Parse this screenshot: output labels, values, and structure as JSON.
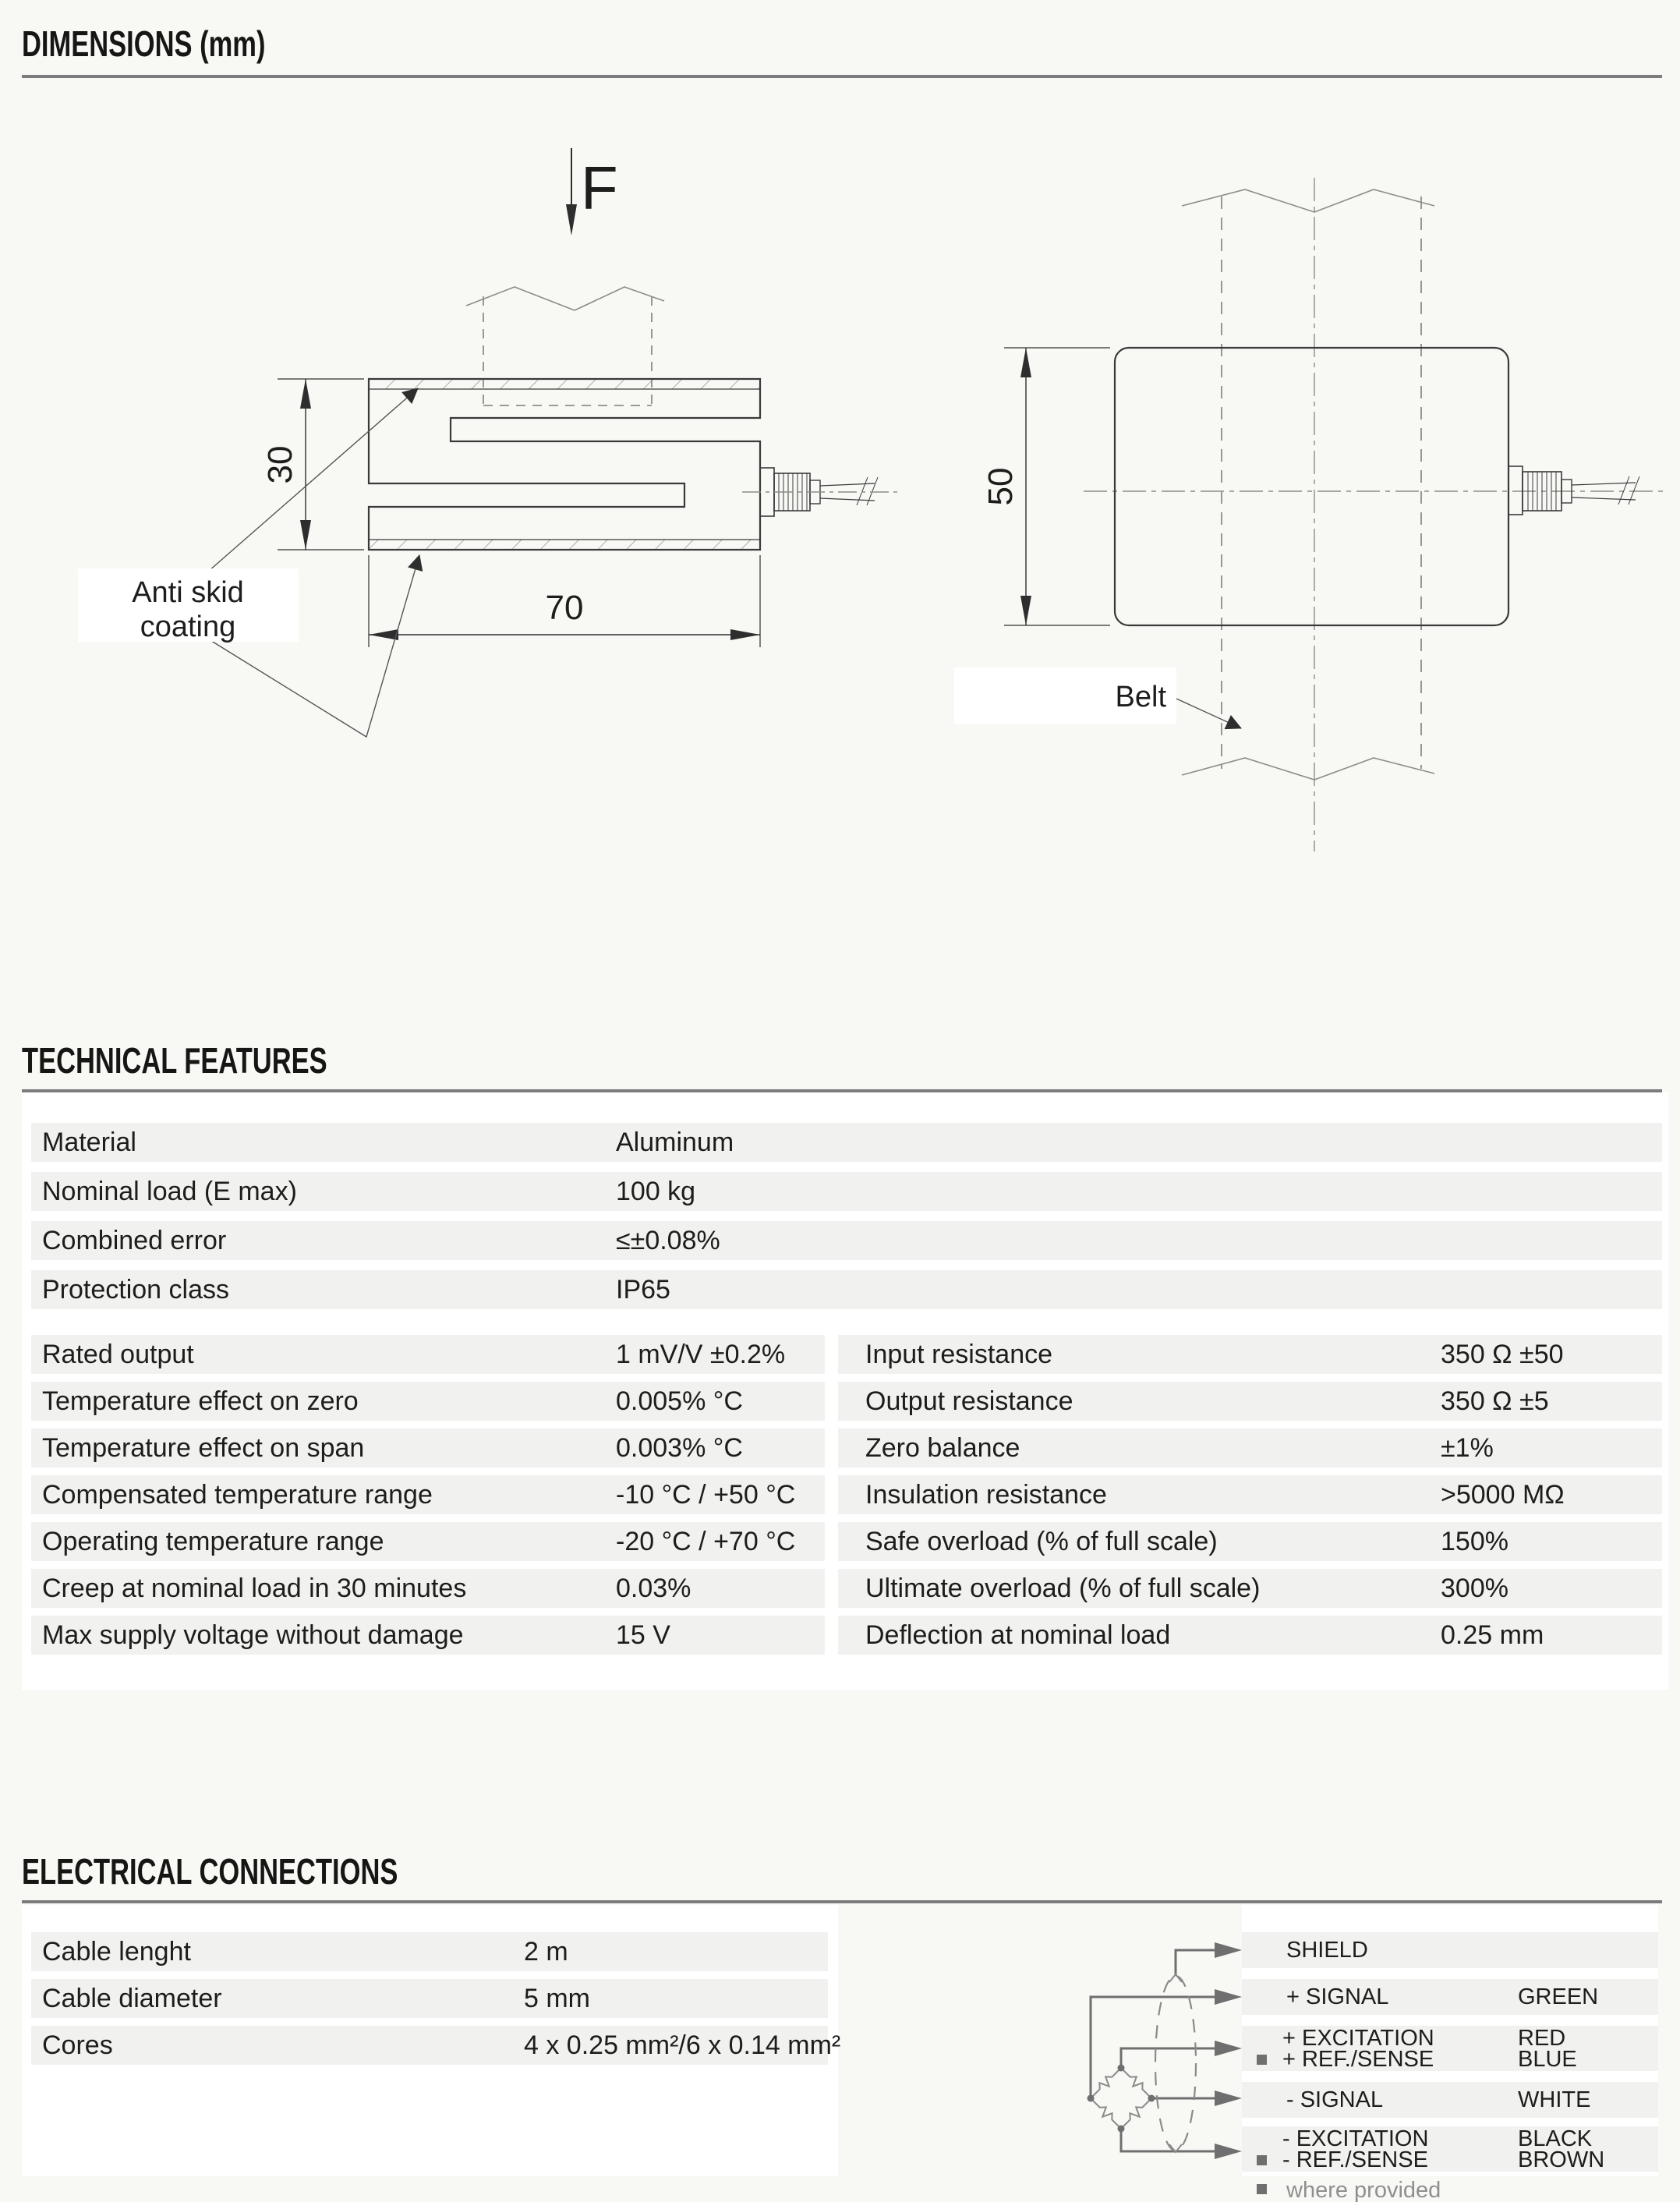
{
  "sections": {
    "dimensions": {
      "title": "DIMENSIONS (mm)"
    },
    "technical": {
      "title": "TECHNICAL FEATURES"
    },
    "electrical": {
      "title": "ELECTRICAL CONNECTIONS"
    }
  },
  "drawing": {
    "force_label": "F",
    "side_height_dim": "30",
    "side_width_dim": "70",
    "front_height_dim": "50",
    "anti_skid_line1": "Anti skid",
    "anti_skid_line2": "coating",
    "belt_label": "Belt"
  },
  "technical_features": {
    "general_rows": [
      {
        "label": "Material",
        "value": "Aluminum"
      },
      {
        "label": "Nominal load (E max)",
        "value": "100 kg"
      },
      {
        "label": "Combined error",
        "value": "≤±0.08%"
      },
      {
        "label": "Protection class",
        "value": "IP65"
      }
    ],
    "left_rows": [
      {
        "label": "Rated output",
        "value": "1 mV/V ±0.2%"
      },
      {
        "label": "Temperature effect on zero",
        "value": "0.005% °C"
      },
      {
        "label": "Temperature effect on span",
        "value": "0.003% °C"
      },
      {
        "label": "Compensated temperature range",
        "value": "-10 °C / +50 °C"
      },
      {
        "label": "Operating temperature range",
        "value": "-20 °C / +70 °C"
      },
      {
        "label": "Creep at nominal load in 30 minutes",
        "value": "0.03%"
      },
      {
        "label": "Max supply voltage without damage",
        "value": "15 V"
      }
    ],
    "right_rows": [
      {
        "label": "Input resistance",
        "value": "350 Ω ±50"
      },
      {
        "label": "Output resistance",
        "value": "350 Ω ±5"
      },
      {
        "label": "Zero balance",
        "value": "±1%"
      },
      {
        "label": "Insulation resistance",
        "value": ">5000 MΩ"
      },
      {
        "label": "Safe overload (% of full scale)",
        "value": "150%"
      },
      {
        "label": "Ultimate overload (% of full scale)",
        "value": "300%"
      },
      {
        "label": "Deflection at nominal load",
        "value": "0.25 mm"
      }
    ]
  },
  "electrical_connections": {
    "cable_rows": [
      {
        "label": "Cable lenght",
        "value": "2 m"
      },
      {
        "label": "Cable diameter",
        "value": "5 mm"
      },
      {
        "label": "Cores",
        "value": "4 x 0.25 mm²/6 x 0.14 mm²"
      }
    ],
    "wiring": {
      "rows": [
        {
          "line1": "SHIELD",
          "color1": ""
        },
        {
          "line1": "+ SIGNAL",
          "color1": "GREEN"
        },
        {
          "line1": "+ EXCITATION",
          "color1": "RED",
          "line2": "+ REF./SENSE",
          "color2": "BLUE"
        },
        {
          "line1": "- SIGNAL",
          "color1": "WHITE"
        },
        {
          "line1": "- EXCITATION",
          "color1": "BLACK",
          "line2": "- REF./SENSE",
          "color2": "BROWN"
        }
      ],
      "footnote": "where provided"
    }
  },
  "colors": {
    "page_bg": "#f8f8f5",
    "panel_bg": "#ffffff",
    "row_bg": "#f1f1ef",
    "rule": "#7c7c7c",
    "text": "#1d1d1b",
    "diagram_line": "#6f6f6f"
  }
}
